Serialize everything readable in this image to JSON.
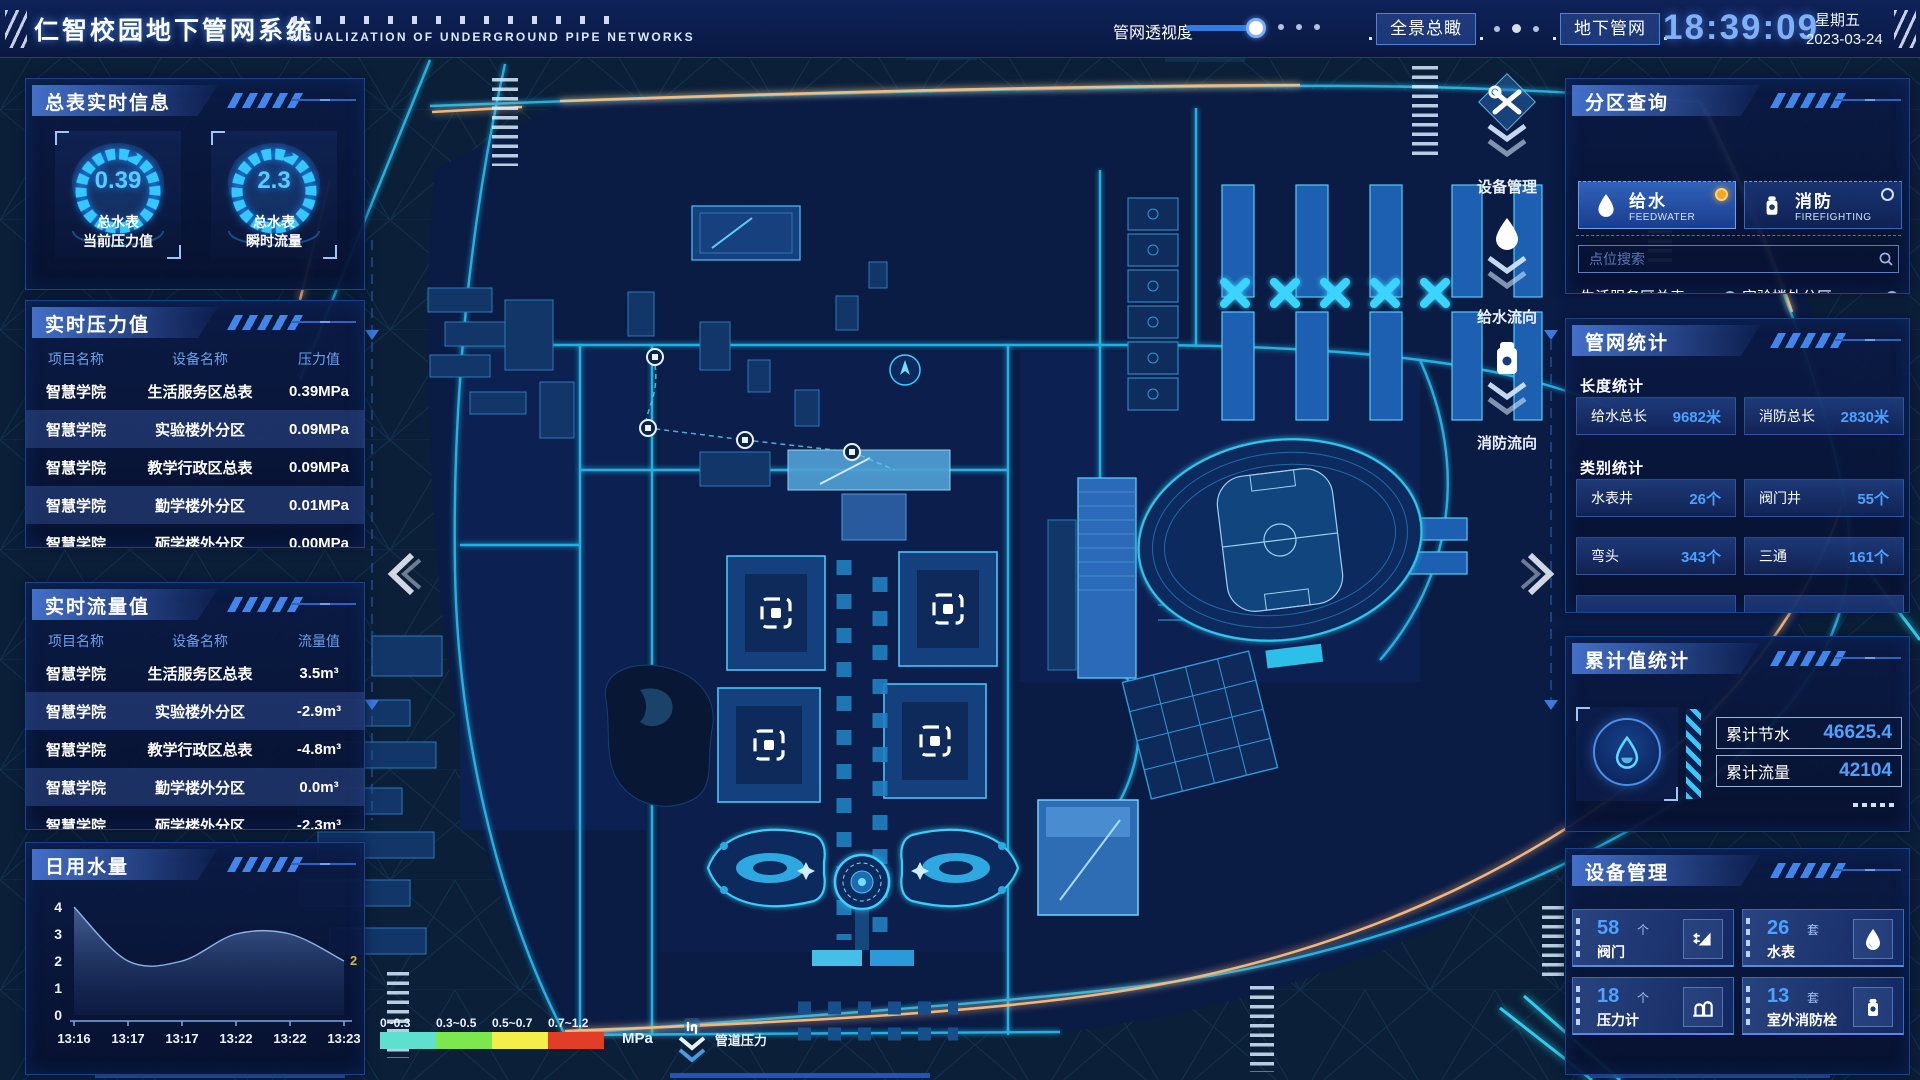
{
  "colors": {
    "accent": "#2ec8f0",
    "value_blue": "#4da2ff",
    "radio_active": "#f6a61e",
    "clock": "#7fb0f8",
    "chart_end_label": "#d8b832"
  },
  "header": {
    "title": "仁智校园地下管网系统",
    "subtitle": "VISUALIZATION OF UNDERGROUND PIPE NETWORKS",
    "slider_label": "管网透视度",
    "btn_overview": "全景总瞰",
    "btn_underground": "地下管网",
    "time": "18:39:09",
    "weekday": "星期五",
    "date": "2023-03-24"
  },
  "left": {
    "meter_panel": {
      "title": "总表实时信息",
      "gauges": [
        {
          "value": "0.39",
          "line1": "总水表",
          "line2": "当前压力值"
        },
        {
          "value": "2.3",
          "line1": "总水表",
          "line2": "瞬时流量"
        }
      ]
    },
    "pressure_panel": {
      "title": "实时压力值",
      "headers": [
        "项目名称",
        "设备名称",
        "压力值"
      ],
      "rows": [
        [
          "智慧学院",
          "生活服务区总表",
          "0.39MPa"
        ],
        [
          "智慧学院",
          "实验楼外分区",
          "0.09MPa"
        ],
        [
          "智慧学院",
          "教学行政区总表",
          "0.09MPa"
        ],
        [
          "智慧学院",
          "勤学楼外分区",
          "0.01MPa"
        ],
        [
          "智慧学院",
          "砺学楼外分区",
          "0.00MPa"
        ]
      ]
    },
    "flow_panel": {
      "title": "实时流量值",
      "headers": [
        "项目名称",
        "设备名称",
        "流量值"
      ],
      "rows": [
        [
          "智慧学院",
          "生活服务区总表",
          "3.5m³"
        ],
        [
          "智慧学院",
          "实验楼外分区",
          "-2.9m³"
        ],
        [
          "智慧学院",
          "教学行政区总表",
          "-4.8m³"
        ],
        [
          "智慧学院",
          "勤学楼外分区",
          "0.0m³"
        ],
        [
          "智慧学院",
          "砺学楼外分区",
          "-2.3m³"
        ]
      ]
    },
    "daily_panel": {
      "title": "日用水量"
    }
  },
  "chart_data": {
    "type": "area",
    "title": "日用水量",
    "x": [
      "13:16",
      "13:17",
      "13:17",
      "13:22",
      "13:22",
      "13:23"
    ],
    "values": [
      4,
      2,
      2,
      3,
      3,
      2
    ],
    "end_label": "2",
    "ylim": [
      0,
      4
    ],
    "yticks": [
      0,
      1,
      2,
      3,
      4
    ],
    "grid": false,
    "legend_position": "none"
  },
  "right": {
    "zone_panel": {
      "title": "分区查询",
      "tabs": [
        {
          "zh": "给水",
          "en": "FEEDWATER",
          "icon": "drop",
          "active": true
        },
        {
          "zh": "消防",
          "en": "FIREFIGHTING",
          "icon": "hydrant",
          "active": false
        }
      ],
      "search_placeholder": "点位搜索",
      "items": [
        "生活服务区总表",
        "实验楼外分区",
        "教学行政区总表",
        "勤学楼外分区",
        "砺学楼外分区",
        "宿舍区泵房"
      ]
    },
    "stats_panel": {
      "title": "管网统计",
      "length_title": "长度统计",
      "length_items": [
        {
          "label": "给水总长",
          "value": "9682米"
        },
        {
          "label": "消防总长",
          "value": "2830米"
        }
      ],
      "category_title": "类别统计",
      "category_items": [
        {
          "label": "水表井",
          "value": "26个"
        },
        {
          "label": "阀门井",
          "value": "55个"
        },
        {
          "label": "弯头",
          "value": "343个"
        },
        {
          "label": "三通",
          "value": "161个"
        }
      ]
    },
    "cumulative_panel": {
      "title": "累计值统计",
      "items": [
        {
          "label": "累计节水",
          "value": "46625.4"
        },
        {
          "label": "累计流量",
          "value": "42104"
        }
      ]
    },
    "device_panel": {
      "title": "设备管理",
      "cards": [
        {
          "count": "58",
          "unit": "个",
          "label": "阀门",
          "icon": "valve"
        },
        {
          "count": "26",
          "unit": "套",
          "label": "水表",
          "icon": "drop"
        },
        {
          "count": "18",
          "unit": "个",
          "label": "压力计",
          "icon": "gauge"
        },
        {
          "count": "13",
          "unit": "套",
          "label": "室外消防栓",
          "icon": "hydrant"
        }
      ]
    }
  },
  "map": {
    "overlays": [
      {
        "label": "设备管理",
        "icon": "tools"
      },
      {
        "label": "给水流向",
        "icon": "drop"
      },
      {
        "label": "消防流向",
        "icon": "hydrant"
      }
    ],
    "legend": {
      "ranges": [
        "0~0.3",
        "0.3~0.5",
        "0.5~0.7",
        "0.7~1.2"
      ],
      "colors": [
        "#5fe0cf",
        "#7ce84e",
        "#f3ee49",
        "#e23d26"
      ],
      "unit": "MPa",
      "pressure_label": "管道压力"
    }
  }
}
